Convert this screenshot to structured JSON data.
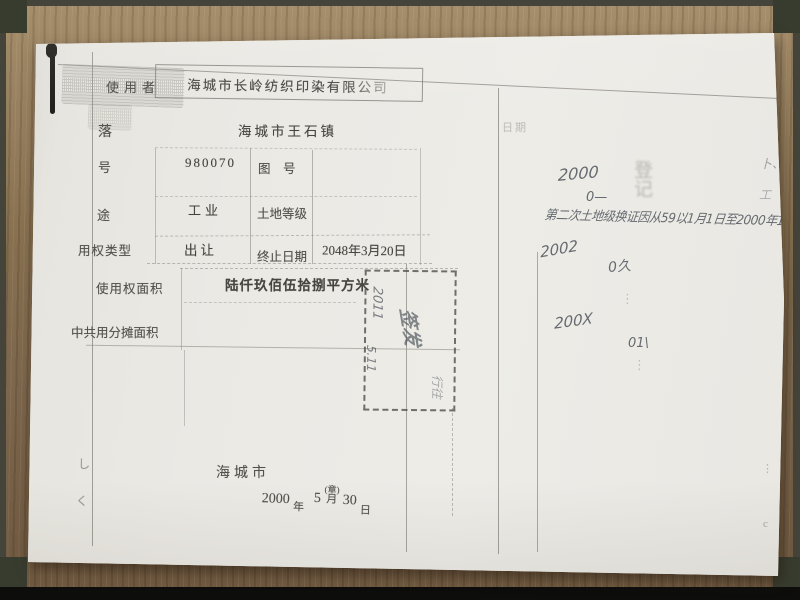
{
  "colors": {
    "wood": "#8a7458",
    "paper": "#eae8e2",
    "print_ink": "#504e48",
    "pencil_ink": "#4e545c",
    "stamp_line": "#5a5952"
  },
  "doc": {
    "rows": [
      {
        "label": "使用者",
        "value": "海城市长岭纺织印染有限公司"
      },
      {
        "label": "落",
        "value": "海城市王石镇"
      },
      {
        "label": "号",
        "value": "980070",
        "sub_label": "图　号",
        "sub_value": ""
      },
      {
        "label": "途",
        "value": "工业",
        "sub_label": "土地等级",
        "sub_value": ""
      },
      {
        "label": "用权类型",
        "value": "出让",
        "sub_label": "终止日期",
        "sub_value": "2048年3月20日"
      },
      {
        "label": "使用权面积",
        "value": "陆仟玖佰伍拾捌平方米"
      },
      {
        "label": "中共用分摊面积",
        "value": ""
      }
    ],
    "issuer": {
      "city": "海城市",
      "year": "2000",
      "year_unit": "年",
      "month": "5",
      "seal_note": "(章)",
      "month_unit": "月",
      "day": "30",
      "day_unit": "日"
    },
    "stamp_box": {
      "rot_text_1": "2011",
      "rot_text_2": "5.11",
      "rot_sign": "签发",
      "rot_text_3": "行往"
    },
    "right_panel": {
      "faint_header": "日期",
      "hw_year_2000": "2000",
      "hw_zero_dash": "0—",
      "faint_seal_chars": "登记",
      "hw_mark_bu": "卜、",
      "hw_mark_gong": "工",
      "hw_note_line": "第二次土地级换证因从59以1月1日至2000年14.",
      "hw_year_2002": "2002",
      "hw_mark_02": "0久",
      "hw_year_200x": "200X",
      "hw_mark_01": "01\\",
      "faint_marks_a": "⋮",
      "faint_marks_b": "⋮"
    },
    "margin_marks": {
      "left_1": "し",
      "left_2": "く",
      "right_1": "⋮",
      "right_2": "c"
    }
  }
}
